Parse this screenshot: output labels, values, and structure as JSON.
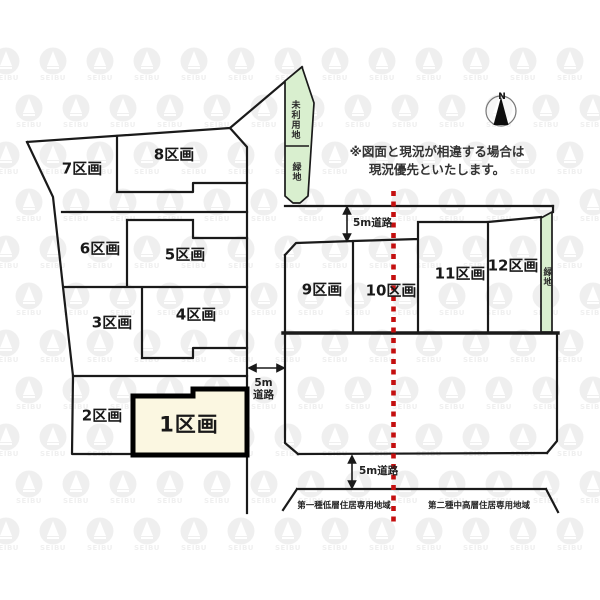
{
  "note": {
    "line1": "※図面と現況が相違する場合は",
    "line2": "現況優先といたします。"
  },
  "compass": {
    "north_label": "N"
  },
  "plots": [
    {
      "id": 1,
      "label": "1区画",
      "highlighted": true
    },
    {
      "id": 2,
      "label": "2区画",
      "highlighted": false
    },
    {
      "id": 3,
      "label": "3区画",
      "highlighted": false
    },
    {
      "id": 4,
      "label": "4区画",
      "highlighted": false
    },
    {
      "id": 5,
      "label": "5区画",
      "highlighted": false
    },
    {
      "id": 6,
      "label": "6区画",
      "highlighted": false
    },
    {
      "id": 7,
      "label": "7区画",
      "highlighted": false
    },
    {
      "id": 8,
      "label": "8区画",
      "highlighted": false
    },
    {
      "id": 9,
      "label": "9区画",
      "highlighted": false
    },
    {
      "id": 10,
      "label": "10区画",
      "highlighted": false
    },
    {
      "id": 11,
      "label": "11区画",
      "highlighted": false
    },
    {
      "id": 12,
      "label": "12区画",
      "highlighted": false
    }
  ],
  "roads": [
    {
      "label": "5m道路"
    },
    {
      "label": "5m道路"
    },
    {
      "label": "5m道路"
    }
  ],
  "green_areas": [
    {
      "label": "未利用地"
    },
    {
      "label": "緑地"
    },
    {
      "label": "緑地"
    }
  ],
  "zones": [
    {
      "label": "第一種低層住居専用地域"
    },
    {
      "label": "第二種中高層住居専用地域"
    }
  ],
  "watermark": {
    "text": "SEIBU"
  },
  "colors": {
    "line": "#1a1a1a",
    "highlight_fill": "#fbf7e1",
    "green_fill": "#d9efcf",
    "boundary_red": "#c40f0f"
  }
}
